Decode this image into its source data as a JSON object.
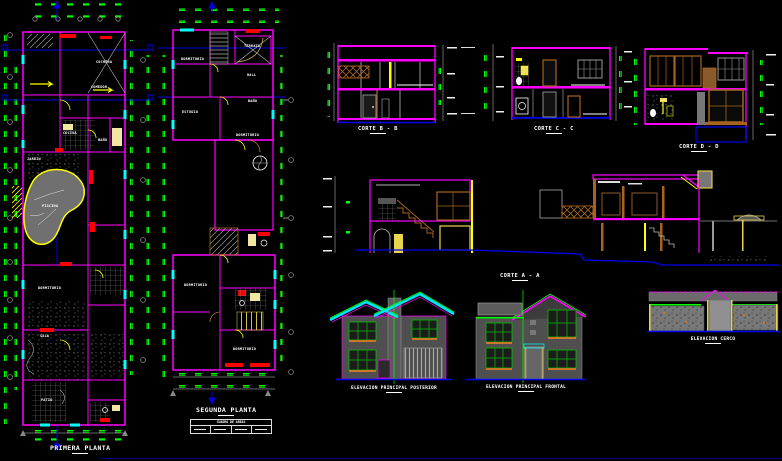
{
  "drawing": {
    "type": "architectural-cad-plan",
    "background": "#000000",
    "palette": {
      "walls": "#FF00FF",
      "dims": "#00FF00",
      "fixtures": "#FFFF00",
      "windows": "#00FFFF",
      "accents": "#FF0000",
      "section_lines": "#0000EE",
      "neutral": "#808080",
      "text": "#FFFFFF",
      "wood": "#A8641E"
    },
    "plans": {
      "primera": {
        "title": "PRIMERA PLANTA",
        "rooms": [
          "COCINA",
          "COMEDOR",
          "SALA",
          "DORMITORIO",
          "PISCINA",
          "JARDIN",
          "PATIO",
          "BAÑO",
          "COCHERA"
        ]
      },
      "segunda": {
        "title": "SEGUNDA PLANTA",
        "rooms": [
          "DORMITORIO",
          "TERRAZA",
          "HALL",
          "BAÑO",
          "DORMITORIO",
          "ESTUDIO",
          "DORMITORIO",
          "DORMITORIO"
        ]
      },
      "title_block": {
        "header": "CUADRO DE AREAS"
      }
    },
    "sections": [
      {
        "label": "CORTE B - B"
      },
      {
        "label": "CORTE C - C"
      },
      {
        "label": "CORTE D - D"
      },
      {
        "label": "CORTE A - A"
      }
    ],
    "elevations": [
      {
        "label": "ELEVACION PRINCIPAL POSTERIOR"
      },
      {
        "label": "ELEVACION PRINCIPAL FRONTAL"
      },
      {
        "label": "ELEVACION CERCO"
      }
    ]
  }
}
